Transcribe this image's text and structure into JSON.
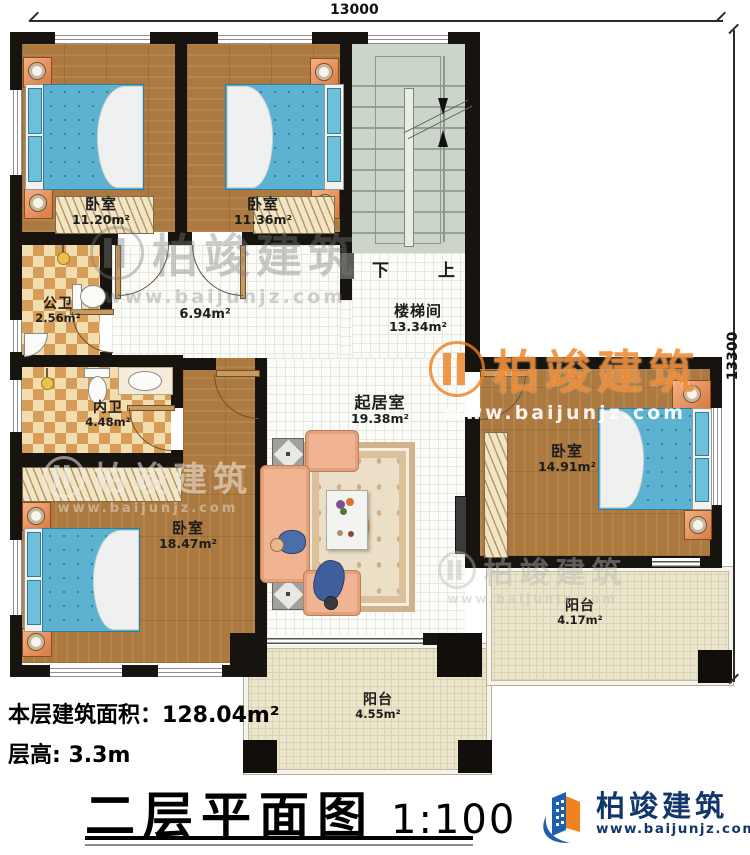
{
  "dimensions": {
    "top": "13000",
    "right": "13300"
  },
  "rooms": {
    "bedroom_tl": {
      "name": "卧室",
      "area": "11.20m²"
    },
    "bedroom_tm": {
      "name": "卧室",
      "area": "11.36m²"
    },
    "stairwell": {
      "name": "楼梯间",
      "area": "13.34m²"
    },
    "hallway": {
      "area": "6.94m²"
    },
    "public_bath": {
      "name": "公卫",
      "area": "2.56m²"
    },
    "private_bath": {
      "name": "内卫",
      "area": "4.48m²"
    },
    "living": {
      "name": "起居室",
      "area": "19.38m²"
    },
    "bedroom_right": {
      "name": "卧室",
      "area": "14.91m²"
    },
    "bedroom_bl": {
      "name": "卧室",
      "area": "18.47m²"
    },
    "balcony_right": {
      "name": "阳台",
      "area": "4.17m²"
    },
    "balcony_bottom": {
      "name": "阳台",
      "area": "4.55m²"
    }
  },
  "stairs": {
    "down": "下",
    "up": "上"
  },
  "footer": {
    "floor_area_label": "本层建筑面积：",
    "floor_area_value": "128.04m²",
    "floor_height_label": "层高:",
    "floor_height_value": "3.3m",
    "plan_title": "二层平面图",
    "plan_scale": "1:100"
  },
  "brand": {
    "name": "柏竣建筑",
    "url": "www.baijunjz.com"
  },
  "colors": {
    "wall": "#17130f",
    "wood": "#ac7a40",
    "bed_blue": "#5cb2d0",
    "bath_tile": "#d69c58",
    "stair_green": "#ccd5c9",
    "balcony_floor": "#ebe5cb",
    "brand_blue": "#14376b",
    "brand_orange": "#ef8320"
  }
}
